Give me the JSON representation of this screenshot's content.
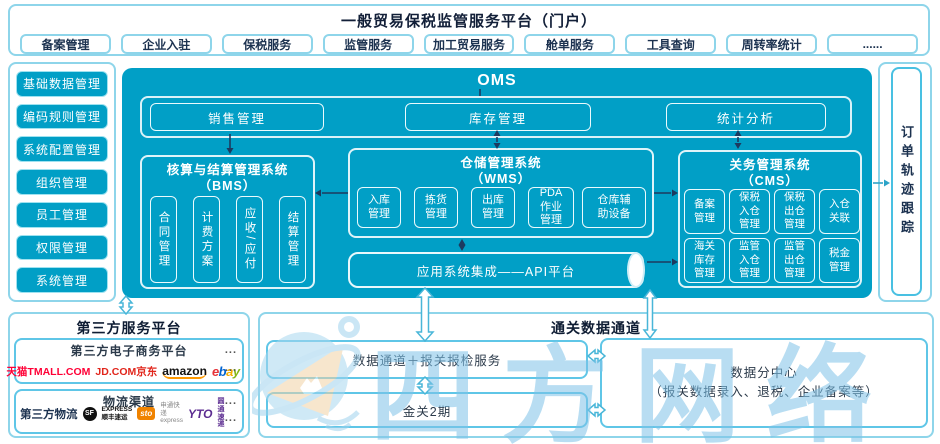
{
  "header": {
    "title": "一般贸易保税监管服务平台（门户）",
    "tabs": [
      "备案管理",
      "企业入驻",
      "保税服务",
      "监管服务",
      "加工贸易服务",
      "舱单服务",
      "工具查询",
      "周转率统计",
      "......"
    ]
  },
  "sidebar": {
    "items": [
      "基础数据管理",
      "编码规则管理",
      "系统配置管理",
      "组织管理",
      "员工管理",
      "权限管理",
      "系统管理"
    ]
  },
  "oms": {
    "title": "OMS",
    "top_modules": [
      "销售管理",
      "库存管理",
      "统计分析"
    ],
    "bms": {
      "title": "核算与结算管理系统",
      "subtitle": "（BMS）",
      "items": [
        "合同管理",
        "计费方案",
        "应收/应付",
        "结算管理"
      ]
    },
    "wms": {
      "title": "仓储管理系统",
      "subtitle": "（WMS）",
      "items": [
        "入库管理",
        "拣货管理",
        "出库管理",
        "PDA作业管理",
        "仓库辅助设备"
      ]
    },
    "cms": {
      "title": "关务管理系统",
      "subtitle": "（CMS）",
      "items": [
        "备案管理",
        "保税入仓管理",
        "保税出仓管理",
        "入仓关联",
        "海关库存管理",
        "监管入仓管理",
        "监管出仓管理",
        "税金管理"
      ]
    },
    "api_bar": "应用系统集成——API平台"
  },
  "order_tracking": "订单轨迹跟踪",
  "third_party": {
    "title": "第三方服务平台",
    "more": "...",
    "ecommerce": {
      "title": "第三方电子商务平台",
      "tmall": "天猫TMALL.COM",
      "jd": "JD.COM京东",
      "amazon": "amazon",
      "ebay_letters": [
        "e",
        "b",
        "a",
        "y"
      ]
    },
    "logistics": {
      "title": "物流渠道",
      "label": "第三方物流",
      "sf_badge": "SF",
      "sf_line1": "EXPRESS",
      "sf_line2": "顺丰速运",
      "sto_badge": "sto",
      "sto_line1": "申通快递",
      "sto_line2": "express",
      "yto_badge": "YTO",
      "yto_text": "圆通速递"
    }
  },
  "customs": {
    "title": "通关数据通道",
    "channel": "数据通道＋报关报检服务",
    "golden_gate": "金关2期",
    "data_center_line1": "数据分中心",
    "data_center_line2": "（报关数据录入、退税、企业备案等）"
  },
  "watermark": {
    "text": "四方网络"
  },
  "colors": {
    "primary_cyan": "#019fc6",
    "outer_border_blue": "#8ed5ea",
    "inner_box_border_blue": "#5fc6e7",
    "text_navy": "#1c3250",
    "arrow_navy": "#1d3a5f",
    "block_arrow_stroke": "#49b6d8",
    "tmall_red": "#ff0036",
    "jd_red": "#e1251b",
    "amazon_orange": "#ff9900",
    "ebay_colors": [
      "#e53238",
      "#0064d2",
      "#f5af02",
      "#86b817"
    ],
    "sf_black": "#111111",
    "sto_orange": "#f08300",
    "yto_purple": "#5c2d91",
    "watermark_blue": "#7fc3e8"
  }
}
